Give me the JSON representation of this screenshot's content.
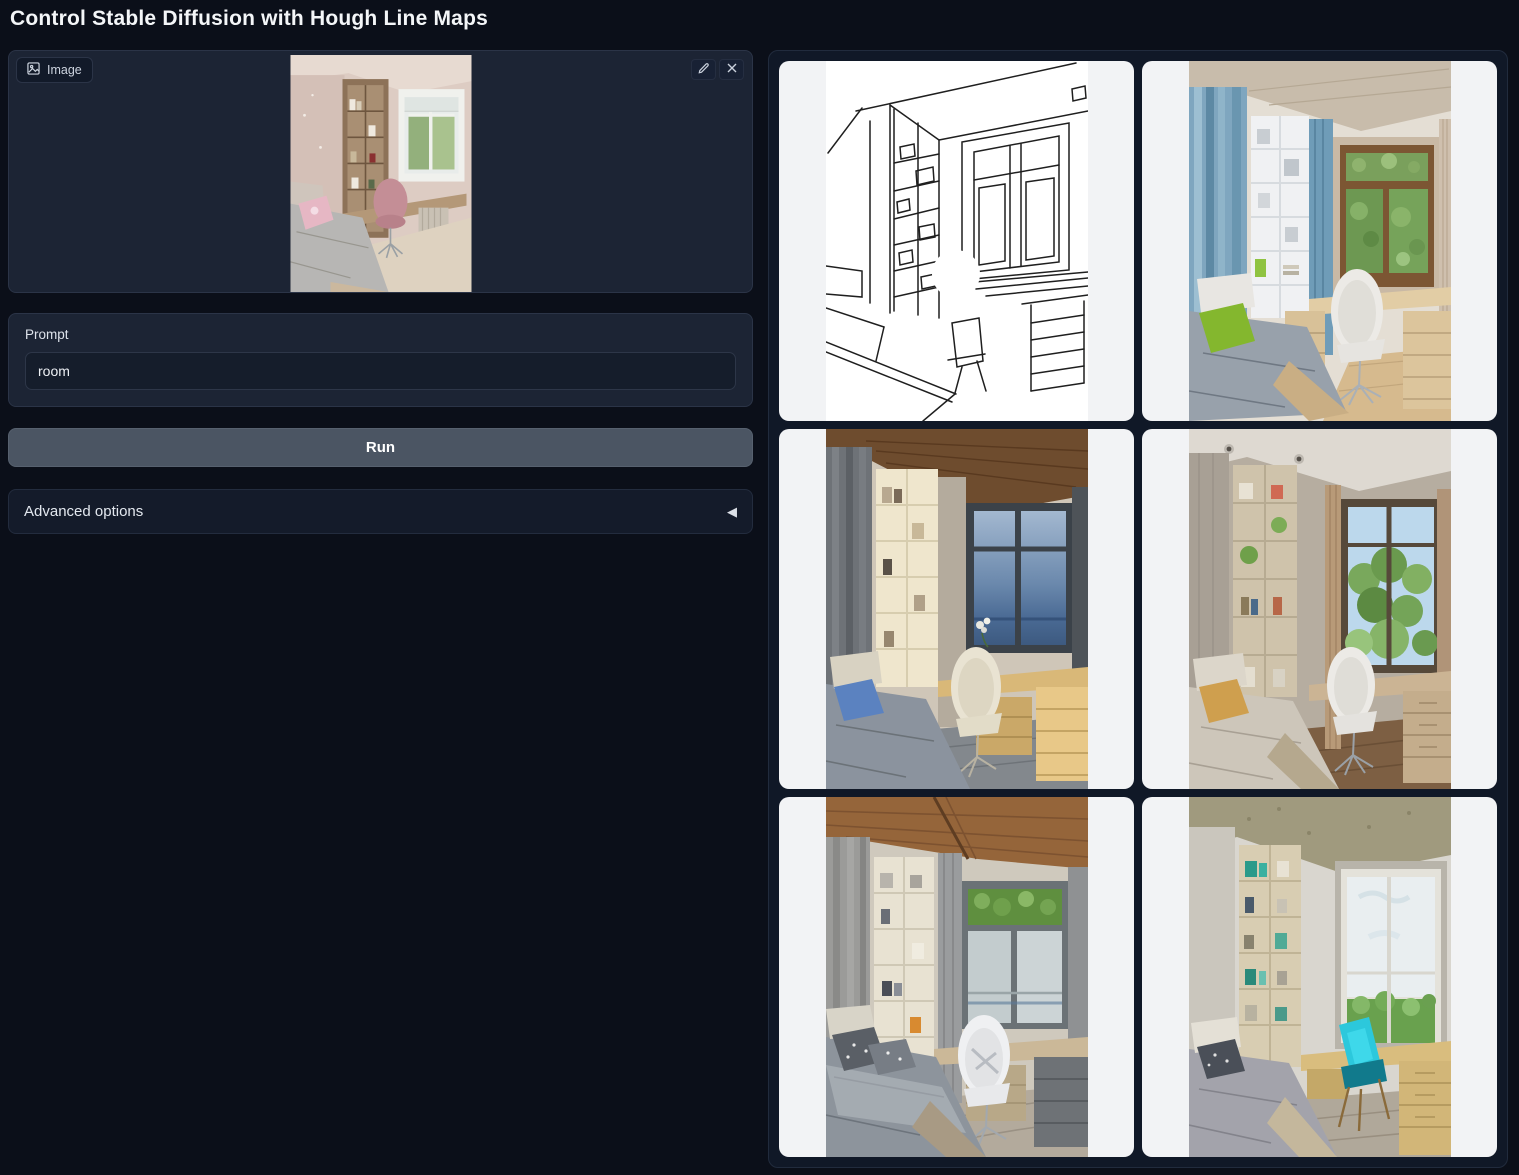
{
  "title": "Control Stable Diffusion with Hough Line Maps",
  "image_input": {
    "label": "Image",
    "icon": "image-icon",
    "edit_icon": "pencil-icon",
    "clear_icon": "x-icon",
    "alt": "uploaded photo of a child bedroom with bookshelf, desk, pink chair and window"
  },
  "prompt": {
    "label": "Prompt",
    "value": "room"
  },
  "run_button": {
    "label": "Run"
  },
  "advanced": {
    "label": "Advanced options",
    "icon": "collapse-left-triangle-icon",
    "arrow": "◀"
  },
  "gallery": {
    "items": [
      {
        "alt": "Hough line map sketch of the room with window, bookshelf, desk and bed"
      },
      {
        "alt": "Generated bedroom with blue curtains, white shelf, wooden window, green pillow, white chair"
      },
      {
        "alt": "Generated bedroom at dusk with dark curtains, cream shelf, blue pillow, lit desk drawers"
      },
      {
        "alt": "Generated bedroom with taupe walls, green trees outside window, tan pillow, white chair"
      },
      {
        "alt": "Generated bedroom with wooden plank ceiling, gray curtains, patterned gray bedding, white chair"
      },
      {
        "alt": "Generated bedroom with bright cyan chair, beige desk drawers, large white-sky window"
      }
    ]
  },
  "colors": {
    "page_bg": "#0b0f19",
    "panel_bg": "#1c2434",
    "card_bg": "#f2f3f5",
    "run_button_bg": "#4b5563",
    "border": "#2b3447"
  }
}
